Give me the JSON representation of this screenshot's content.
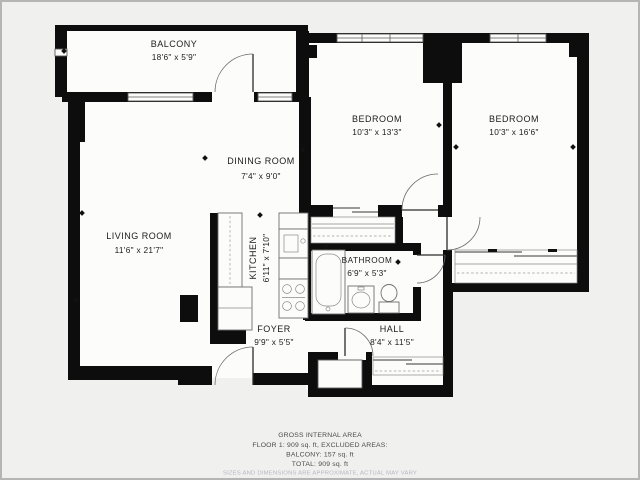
{
  "plan": {
    "title": "Apartment floor plan",
    "rooms": {
      "balcony": {
        "name": "BALCONY",
        "dims": "18'6\" x 5'9\""
      },
      "dining": {
        "name": "DINING ROOM",
        "dims": "7'4\" x 9'0\""
      },
      "living": {
        "name": "LIVING ROOM",
        "dims": "11'6\" x 21'7\""
      },
      "kitchen": {
        "name": "KITCHEN",
        "dims": "6'11\" x 7'10\""
      },
      "bedroom1": {
        "name": "BEDROOM",
        "dims": "10'3\" x 13'3\""
      },
      "bedroom2": {
        "name": "BEDROOM",
        "dims": "10'3\" x 16'6\""
      },
      "bathroom": {
        "name": "BATHROOM",
        "dims": "6'9\" x 5'3\""
      },
      "foyer": {
        "name": "FOYER",
        "dims": "9'9\" x 5'5\""
      },
      "hall": {
        "name": "HALL",
        "dims": "8'4\" x 11'5\""
      }
    },
    "footer": {
      "line1": "GROSS INTERNAL AREA",
      "line2": "FLOOR 1: 909 sq. ft, EXCLUDED AREAS:",
      "line3": "BALCONY: 157 sq. ft",
      "line4": "TOTAL: 909 sq. ft",
      "disclaimer": "SIZES AND DIMENSIONS ARE APPROXIMATE, ACTUAL MAY VARY"
    },
    "colors": {
      "wall": "#0d0d0d",
      "background": "#f0f0ee",
      "room_fill": "#fcfcfb",
      "fixture_stroke": "#6f6f6f",
      "label_text": "#1c1c1c",
      "footer_text": "#4a4a4a",
      "disclaimer_text": "#b4b7c2"
    }
  }
}
